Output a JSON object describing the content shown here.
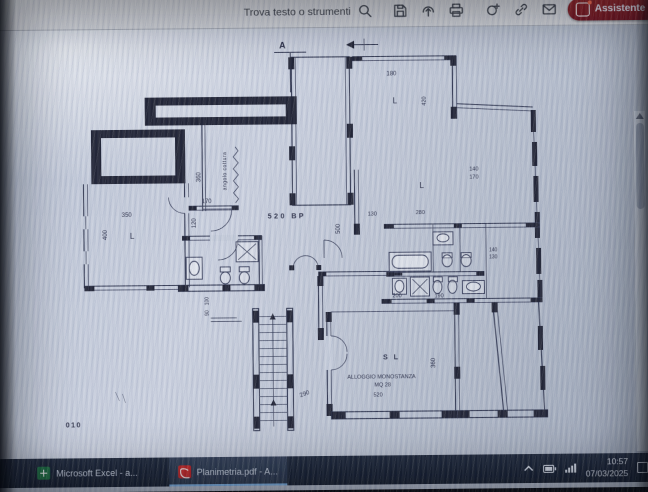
{
  "toolbar": {
    "search_label": "Trova testo o strumenti",
    "ai_button_label": "Assistente IA"
  },
  "plan": {
    "labels": [
      {
        "text": "A"
      },
      {
        "text": "180"
      },
      {
        "text": "L"
      },
      {
        "text": "420"
      },
      {
        "text": "140"
      },
      {
        "text": "170"
      },
      {
        "text": "L"
      },
      {
        "text": "350"
      },
      {
        "text": "L"
      },
      {
        "text": "400"
      },
      {
        "text": "170"
      },
      {
        "text": "120"
      },
      {
        "text": "520  BP"
      },
      {
        "text": "angolo cottura"
      },
      {
        "text": "360"
      },
      {
        "text": "500"
      },
      {
        "text": "130"
      },
      {
        "text": "280"
      },
      {
        "text": "140"
      },
      {
        "text": "130"
      },
      {
        "text": "200"
      },
      {
        "text": "190"
      },
      {
        "text": "S L"
      },
      {
        "text": "360"
      },
      {
        "text": "ALLOGGIO  MONOSTANZA"
      },
      {
        "text": "MQ 28"
      },
      {
        "text": "520"
      },
      {
        "text": "290"
      },
      {
        "text": "010"
      },
      {
        "text": "100"
      },
      {
        "text": "90"
      }
    ]
  },
  "taskbar": {
    "items": [
      {
        "label": "Microsoft Excel - a..."
      },
      {
        "label": "Planimetria.pdf - A..."
      }
    ],
    "tray": {
      "time": "10:57",
      "date": "07/03/2025"
    }
  },
  "colors": {
    "ai_button": "#8f1d22",
    "taskbar_bg": "#1b2335",
    "excel_green": "#1d6f42",
    "acrobat_red": "#c62828",
    "plan_line": "#373d56"
  }
}
